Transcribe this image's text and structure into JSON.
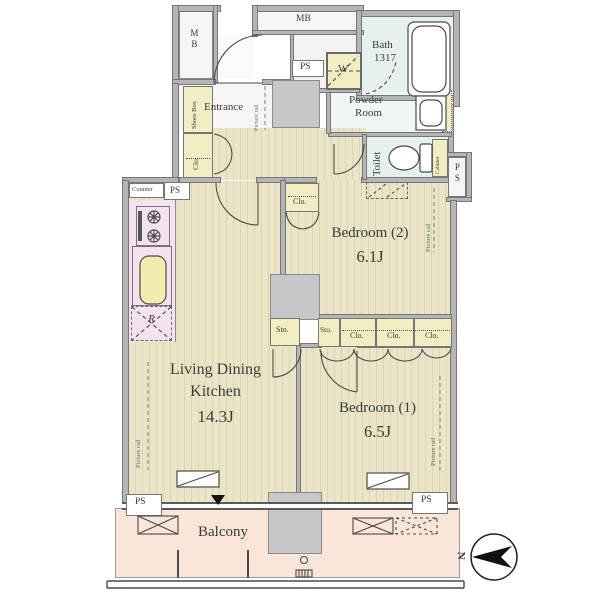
{
  "plan": {
    "rooms": {
      "ldk": {
        "name1": "Living Dining",
        "name2": "Kitchen",
        "size": "14.3J"
      },
      "bedroom1": {
        "name": "Bedroom (1)",
        "size": "6.5J"
      },
      "bedroom2": {
        "name": "Bedroom (2)",
        "size": "6.1J"
      },
      "bath": {
        "name": "Bath",
        "size": "1317"
      },
      "powder_room": {
        "name1": "Powder",
        "name2": "Room"
      },
      "toilet": "Toilet",
      "entrance": "Entrance",
      "balcony": "Balcony"
    },
    "labels": {
      "mb": "MB",
      "ps": "PS",
      "w": "W",
      "r": "R",
      "counter": "Counter",
      "shoes_box": "Shoes Box",
      "clo": "Clo.",
      "sto": "Sto.",
      "cabinet": "Cabinet",
      "picture_rail": "Picture rail",
      "north": "N"
    },
    "closet_row": [
      "Sto.",
      "Clo.",
      "Clo.",
      "Clo."
    ],
    "colors": {
      "wood_floor": "#e9e4c4",
      "wet_area": "#e7f0f1",
      "closet": "#f2edc3",
      "kitchen": "#f6e2ee",
      "balcony": "#fae6d9",
      "wall": "#b5b5b5",
      "column": "#c7c7cb",
      "line": "#4a4a4a"
    }
  }
}
